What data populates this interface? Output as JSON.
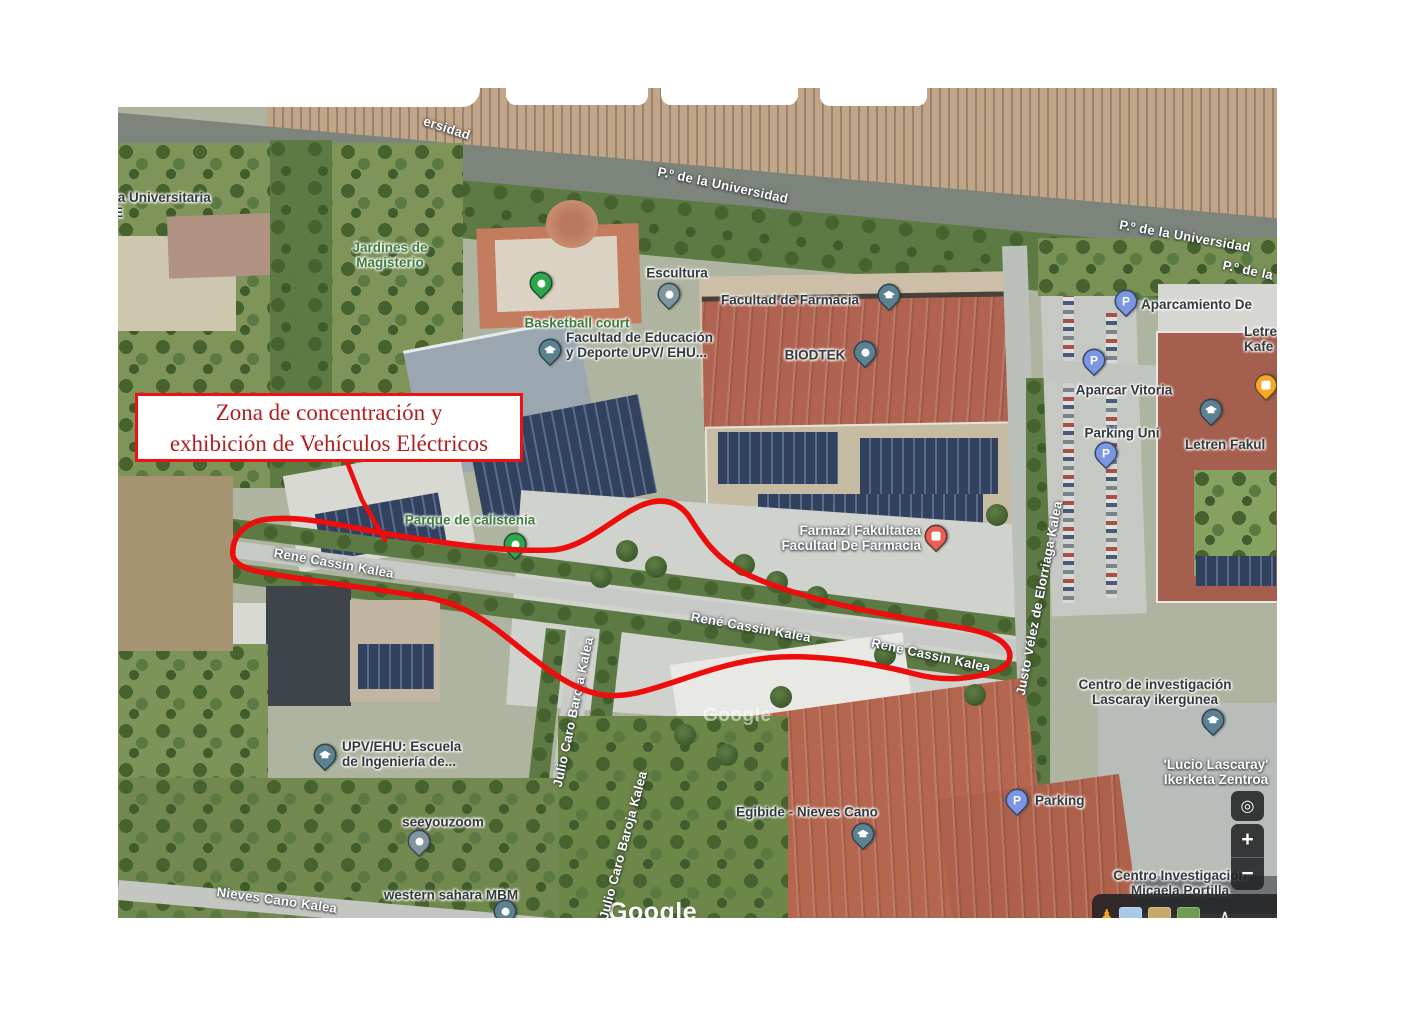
{
  "annotation": {
    "line1": "Zona de concentración y",
    "line2": "exhibición de Vehículos Eléctricos",
    "border_color": "#ee1212",
    "text_color": "#b02020",
    "zone_outline_color": "#ed0d0d"
  },
  "streets": [
    "ersidad",
    "P.º de la Universidad",
    "P.º de la Universidad",
    "P.º de la",
    "René Cassin Kalea",
    "René Cassin Kalea",
    "René Cassin Kalea",
    "Justo Vélez de Elorriaga Kalea",
    "Julio Caro Baroja Kalea",
    "Julio Caro Baroja Kalea",
    "Nieves Cano Kalea"
  ],
  "pois": {
    "universitaria_1": "ia Universitaria",
    "universitaria_2": "E",
    "jardines_1": "Jardines de",
    "jardines_2": "Magisterio",
    "basketball": "Basketball court",
    "escultura": "Escultura",
    "facultad_farmacia": "Facultad de Farmacia",
    "biodtek": "BIODTEK",
    "educacion_1": "Facultad de Educación",
    "educacion_2": "y Deporte UPV/ EHU...",
    "calistenia": "Parque de calistenia",
    "farmazi_1": "Farmazi Fakultatea",
    "farmazi_2": "Facultad De Farmacia",
    "aparcamiento": "Aparcamiento De",
    "aparcar_vitoria": "Aparcar Vitoria",
    "parking_uni": "Parking Uni",
    "letren_kafe_1": "Letre",
    "letren_kafe_2": "Kafe",
    "letren_fakultatea": "Letren Fakul",
    "lascaray_1": "Centro de investigación",
    "lascaray_2": "Lascaray ikergunea",
    "lucio_1": "'Lucio Lascaray'",
    "lucio_2": "Ikerketa Zentroa",
    "parking": "Parking",
    "upv_1": "UPV/EHU: Escuela",
    "upv_2": "de Ingeniería de...",
    "seeyouzoom": "seeyouzoom",
    "western_sahara": "western sahara MBM",
    "egibide": "Egibide - Nieves Cano",
    "micaela_1": "Centro Investigación",
    "micaela_2": "Micaela Portilla"
  },
  "controls": {
    "zoom_in": "+",
    "zoom_out": "−",
    "locate_glyph": "◎",
    "collapse_glyph": "∧"
  },
  "icons": {
    "parking_letter": "P",
    "pegman_glyph": "♟",
    "education_pin": "graduation-cap",
    "pharmacy_pin": "pharmacy",
    "cafe_pin": "cafe"
  },
  "watermark": {
    "center": "Google",
    "bottom": "Google"
  }
}
